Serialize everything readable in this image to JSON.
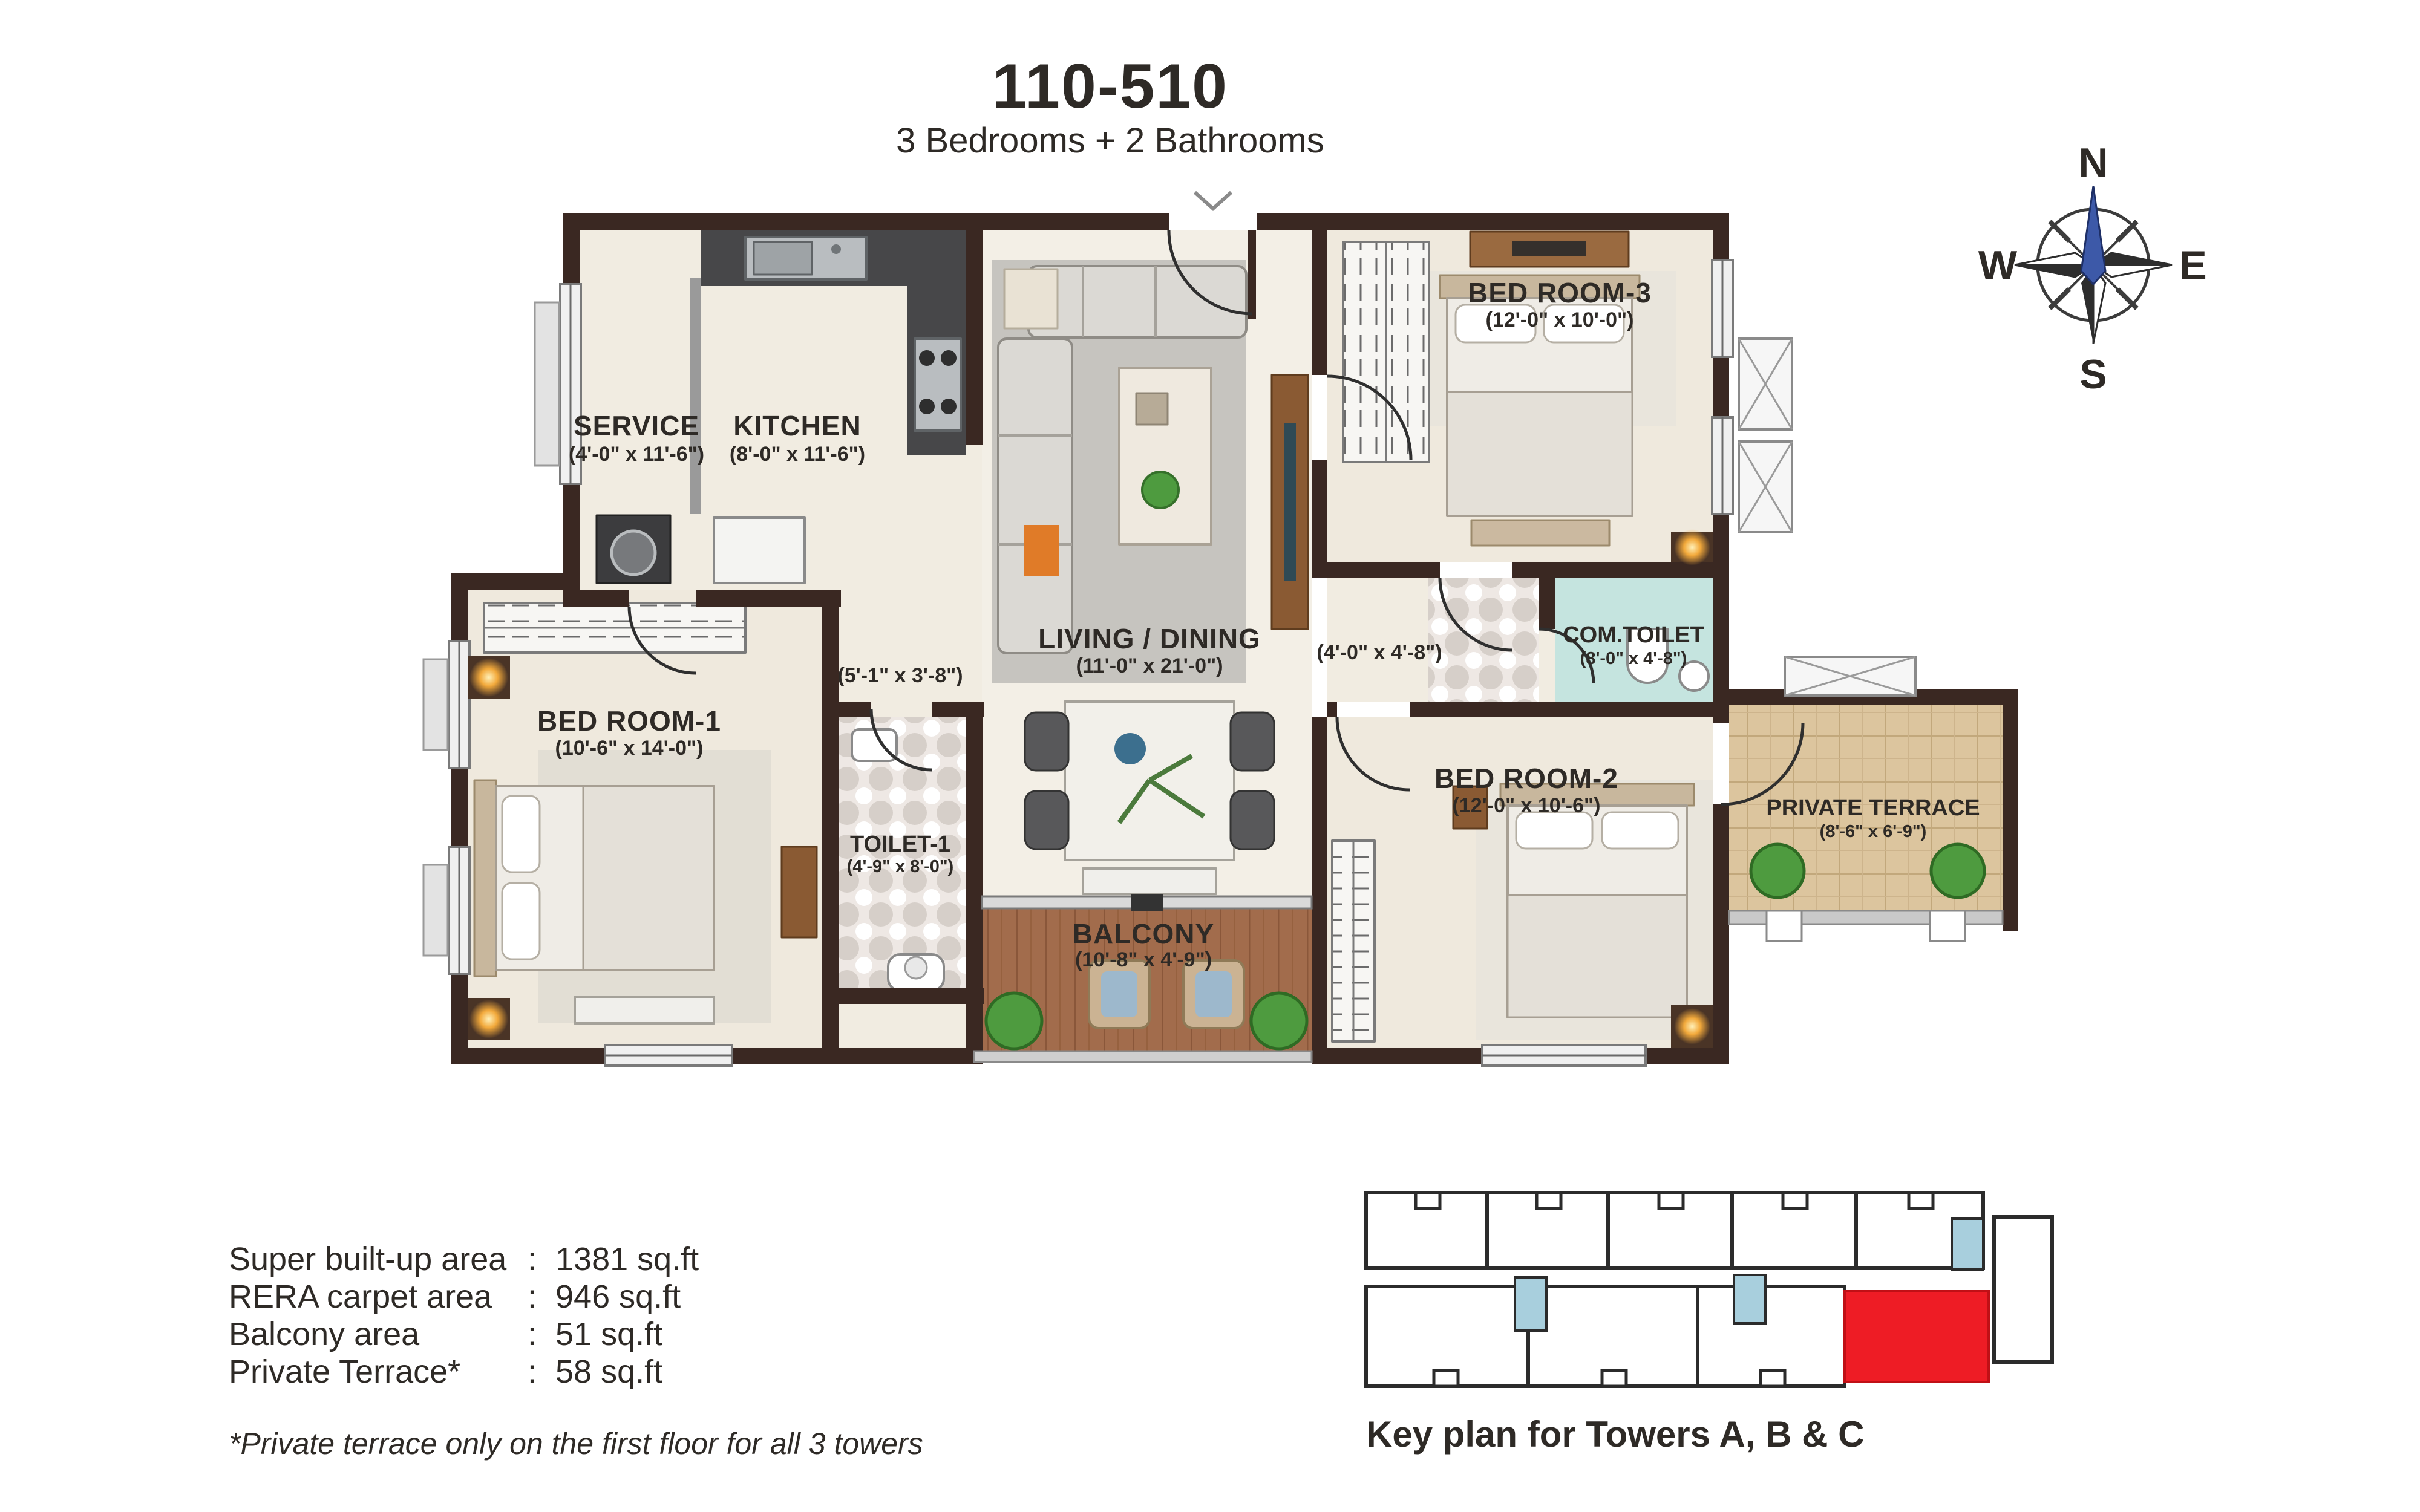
{
  "title": "110-510",
  "subtitle": "3 Bedrooms + 2 Bathrooms",
  "compass": {
    "north": "N",
    "east": "E",
    "south": "S",
    "west": "W"
  },
  "rooms": {
    "service": {
      "name": "SERVICE",
      "dims": "(4'-0\" x 11'-6\")"
    },
    "kitchen": {
      "name": "KITCHEN",
      "dims": "(8'-0\" x 11'-6\")"
    },
    "living": {
      "name": "LIVING / DINING",
      "dims": "(11'-0\" x 21'-0\")"
    },
    "bedroom3": {
      "name": "BED ROOM-3",
      "dims": "(12'-0\" x 10'-0\")"
    },
    "comtoilet": {
      "name": "COM.TOILET",
      "dims": "(8'-0\" x 4'-8\")"
    },
    "bedroom1": {
      "name": "BED ROOM-1",
      "dims": "(10'-6\" x 14'-0\")"
    },
    "toilet1": {
      "name": "TOILET-1",
      "dims": "(4'-9\" x 8'-0\")"
    },
    "bedroom2": {
      "name": "BED ROOM-2",
      "dims": "(12'-0\" x 10'-6\")"
    },
    "balcony": {
      "name": "BALCONY",
      "dims": "(10'-8\" x 4'-9\")"
    },
    "terrace": {
      "name": "PRIVATE TERRACE",
      "dims": "(8'-6\" x 6'-9\")"
    }
  },
  "passages": {
    "p1": {
      "dims": "(5'-1\" x 3'-8\")"
    },
    "p2": {
      "dims": "(4'-0\" x 4'-8\")"
    }
  },
  "areas": {
    "rows": [
      {
        "label": "Super built-up area",
        "colon": ":",
        "value": "1381 sq.ft"
      },
      {
        "label": "RERA carpet area",
        "colon": ":",
        "value": "946 sq.ft"
      },
      {
        "label": "Balcony area",
        "colon": ":",
        "value": "51 sq.ft"
      },
      {
        "label": "Private Terrace*",
        "colon": ":",
        "value": "58 sq.ft"
      }
    ],
    "footnote": "*Private terrace only on the first floor for all 3 towers"
  },
  "keyplan": {
    "caption": "Key plan for Towers A, B & C"
  },
  "colors": {
    "accent_red": "#ee1c25",
    "compass_needle": "#3d59a8",
    "wall_brown": "#3a2822",
    "com_toilet_floor": "#c5e4df",
    "keyplan_core_blue": "#a8cfdd",
    "balcony_wood": "#a26c4c",
    "terrace_tile": "#dcc59e"
  }
}
